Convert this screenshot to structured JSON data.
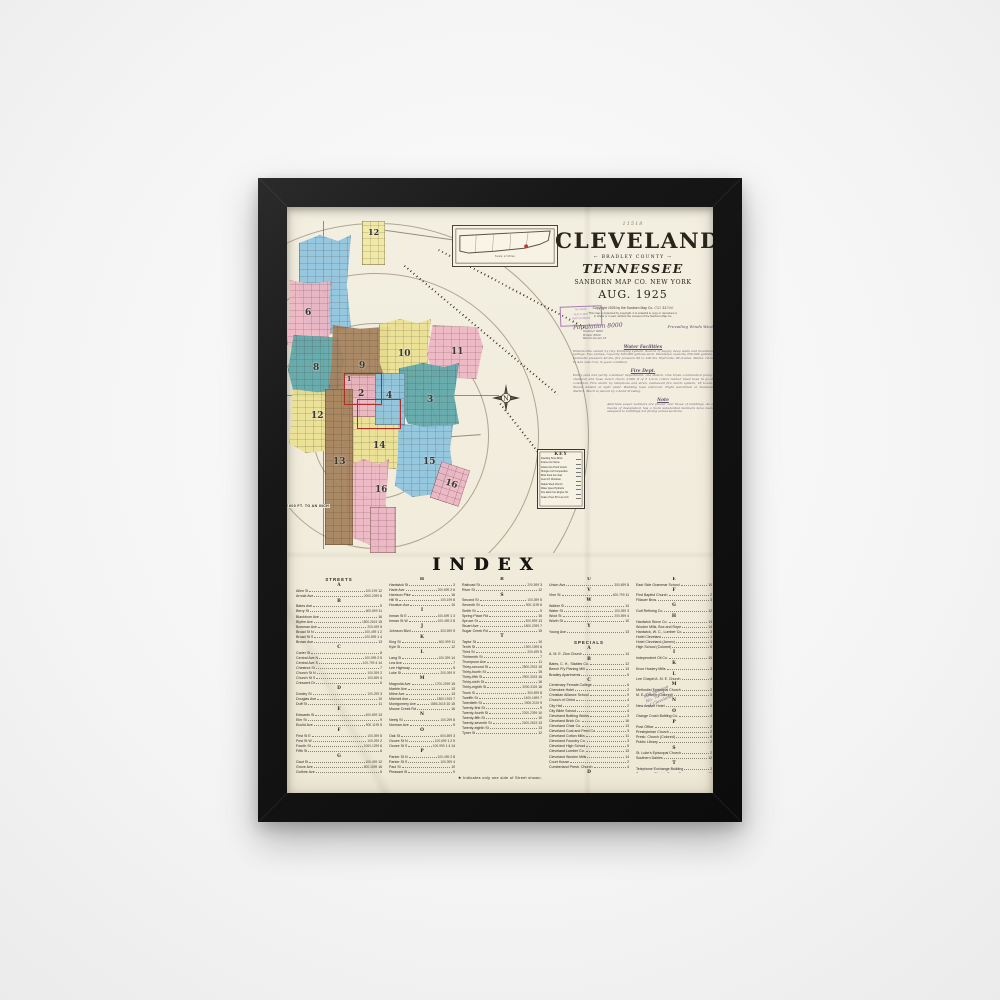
{
  "title_block": {
    "scrawl_top": "11518",
    "city": "CLEVELAND",
    "county_line": "← BRADLEY COUNTY →",
    "state": "TENNESSEE",
    "publisher": "SANBORN MAP CO. NEW YORK",
    "date": "AUG. 1925",
    "copyright": "Copyright 1925 by the Sanborn Map Co.",
    "serial": "CSI 44506",
    "legal_1": "This map is protected by copyright. It is unlawful to copy or reproduce it,",
    "legal_2": "in whole or in part, without the consent of the Sanborn Map Co."
  },
  "stamp": {
    "lines": [
      "No 11518",
      "AUG 6 1925",
      "MAP DIVISION"
    ]
  },
  "notes": {
    "population": "Population 8000",
    "winds": "Prevailing Winds West",
    "pop_sub_1": "Summer 9000",
    "pop_sub_2": "Winter 8000",
    "pop_sub_3": "Wards shown 16",
    "water_heading": "Water Facilities",
    "water_text": "Waterworks owned by city. Pumping system. Source of supply deep wells and mountain springs. Two pumps, capacity 500,000 gallons each. Standpipe capacity 250,000 gallons. Domestic pressure 40 lbs, fire pressure 60 to 100 lbs. Hydrants: 96 double. Mains: 10-in to 4-in cast iron, in good condition.",
    "fire_heading": "Fire Dept.",
    "fire_text": "Partly paid and partly volunteer department, one station. One triple combination pump, chemical and hose motor truck; 2,000 ft of 2 1/2-in cotton rubber lined hose in good condition. Fire alarm by telephone and siren. Gamewell fire alarm system, 18 boxes. Steam whistle at light plant. Building laws enforced. Night watchman at business district. Much is placed by a hand drawing.",
    "note_heading": "Note",
    "note_text": "Alternate paper numbers are placed over those of buildings. As a means of designation has a more substantial numbers have been assigned to buildings not facing actual sections."
  },
  "map": {
    "wards": [
      "12",
      "7",
      "6",
      "8",
      "9",
      "10",
      "11",
      "2",
      "4",
      "3",
      "12",
      "13",
      "14",
      "15",
      "16",
      "16",
      "1"
    ],
    "scale_label": "600 FT. TO AN INCH",
    "compass_letter": "N",
    "inset_caption": "Scale of Miles",
    "colors": {
      "pink": "#edb6c4",
      "blue": "#8ec4df",
      "teal": "#5fa7ab",
      "brown": "#a5825e",
      "yellow": "#ebe193",
      "red_outline": "#a8322a"
    }
  },
  "key": {
    "title": "KEY",
    "lines": [
      "Dwelling  Store  Brick",
      "Frame  Iron  Stone",
      "Adobe  Fire Proof Constr.",
      "Shingle roof  Composition",
      "Brick lined  Iron clad",
      "Auto  F.P.  Windows",
      "Stable  Shed  Church",
      "Water pipes  Hydrants",
      "Fire alarm box  Engine Ho.",
      "Scale of feet 50 to an inch"
    ]
  },
  "side_note": {
    "line_1": "Mill Division",
    "line_2": "No. 70-72",
    "line_3": "of Cleveland"
  },
  "index": {
    "title": "INDEX",
    "footnote": "★ Indicates only one side of Street shown.",
    "columns": [
      [
        "!STREETS",
        "#A",
        "Allen St|100-199|12",
        "Arnold Ave|2000-2099|6",
        "#B",
        "Bates Ave||9",
        "Berry St|600-899|11",
        "Blackburn Ave||16",
        "Blythe Ave|1800-2615|15",
        "Bowman Ave|200-499|5",
        "Broad St N|100-499|1 2",
        "Broad St S|100-899|1 4",
        "Brown Ave||13",
        "#C",
        "Carter St||8",
        "Central Ave N|100-599|2 5",
        "Central Ave S|100-799|4 14",
        "Chestnut St||7",
        "Church St N|100-399|2",
        "Church St S|100-599|4",
        "Crescent Dr||6",
        "#D",
        "Dooley St|100-299|3",
        "Douglas Ave||10",
        "Duff St||11",
        "#E",
        "Edwards St|400-699|13",
        "Elm St||9",
        "Euclid Ave|900-1199|5",
        "#F",
        "First St E|100-399|5",
        "First St W|100-299|2",
        "Fourth St|1000-1299|6",
        "Fifth St||6",
        "#G",
        "Gaut St|100-499|12",
        "Grove Ave|800-1099|16",
        "Guthrie Ave||5"
      ],
      [
        "#H",
        "Hardwick St||3",
        "Harle Ave|200-899|2 6",
        "Harrison Pike||16",
        "Hill St|100-199|8",
        "Houston Ave||10",
        "#I",
        "Inman St E|100-699|1 3",
        "Inman St W|100-499|2 8",
        "#J",
        "Johnson Blvd|300-599|5",
        "#K",
        "King St|600-999|11",
        "Kyle St||12",
        "#L",
        "Lang St|100-399|14",
        "Lea Ave||7",
        "Lee Highway||5",
        "Luke St|200-399|9",
        "#M",
        "Magnolia Ave|1700-2099|15",
        "Marble Ave||13",
        "Milne Ave||13",
        "Mitchell Ave|1800-1915|7",
        "Montgomery Ave|1886-2615|10 15",
        "Mouse Creek Rd||16",
        "#N",
        "Neely St|100-299|8",
        "Norman Ave||9",
        "#O",
        "Oak St|600-899|3",
        "Ocoee St N|100-699|1 2 5",
        "Ocoee St S|100-999|1 4 14",
        "#P",
        "Parker St N|100-499|2 8",
        "Parker St S|100-399|4",
        "Paul St||10",
        "Pleasant St||9"
      ],
      [
        "#R",
        "Railroad St|200-599|3",
        "River St||12",
        "#S",
        "Second St|100-399|5",
        "Seventh St|900-1199|6",
        "Smith St||9",
        "Spring Place Rd||16",
        "Spruce St|300-599|13",
        "Stuart Ave|1800-2099|7",
        "Sugar Creek Rd||15",
        "#T",
        "Taylor St||10",
        "Tenth St|1300-1599|6",
        "Third St|200-499|5",
        "Thirteenth St||7",
        "Thompson Ave||11",
        "Thirty-second St|2800-2915|15",
        "Thirty-fourth St||15",
        "Thirty-fifth St|2900-3015|16",
        "Thirty-sixth St||16",
        "Thirty-eighth St|3000-3115|16",
        "Trunk St|300-599|8",
        "Twelfth St|1400-1699|7",
        "Twentieth St|1900-2115|9",
        "Twenty-first St||9",
        "Twenty-fourth St|2200-2399|10",
        "Twenty-fifth St||10",
        "Twenty-seventh St|2400-2615|13",
        "Twenty-eighth St||13",
        "Tyner St||12"
      ],
      [
        "#U",
        "Union Ave|300-699|8",
        "#V",
        "Vine St|400-799|11",
        "#W",
        "Walker St||14",
        "Water St|100-399|3",
        "Wool St|200-599|4",
        "Worth St||10",
        "#Y",
        "Young Ave||13",
        "",
        "!SPECIALS",
        "#A",
        "A. M. E. Zion Church||14",
        "#B",
        "Bates, C. H., Stables Co.||12",
        "Beech R'y Planing Mill||13",
        "Bradley Apartments||5",
        "#C",
        "Centenary Female College||6",
        "Cherokee Hotel||2",
        "Christian Alliance School||9",
        "Church of Christ||4",
        "City Hall||2",
        "City Bible School||4",
        "Cleveland Bottling Works||3",
        "Cleveland Brick Co.||16",
        "Cleveland Chair Co.||13",
        "Cleveland Coal and Feed Co.||3",
        "Cleveland Cotton Mills||11",
        "Cleveland Foundry Co.||3",
        "Cleveland High School||5",
        "Cleveland Lumber Co.||13",
        "Cleveland Woolen Mills||14",
        "Court House||2",
        "Cumberland Presb. Church||4",
        "#D",
        "Dixie Foundry Co.||12"
      ],
      [
        "#E",
        "East Side Grammar School||10",
        "#F",
        "First Baptist Church||2",
        "Fillauer Bros.||3",
        "#G",
        "Gulf Refining Co.||12",
        "#H",
        "Hardwick Stove Co.||14",
        "Woolen Mills, Box and Rope||14",
        "Hardwick, W. C., Lumber Co.||3",
        "Hotel Cleveland||1",
        "Hotel Cleveland (Annex)||1",
        "High School (Colored)||8",
        "#I",
        "Independent Oil Co.||10",
        "#K",
        "Knox Hosiery Mills||3",
        "#L",
        "Lee Chapel A. M. E. Church||4",
        "#M",
        "Methodist Episcopal Church||2",
        "M. E. Church (Colored)||3",
        "#N",
        "New Amaze Hotel||5",
        "#O",
        "Orange Crush Bottling Co.||4",
        "#P",
        "Post Office||2",
        "Presbyterian Church||2",
        "Presb. Church (Colored)||8",
        "Public Library||2",
        "#S",
        "St. Luke's Episcopal Church||2",
        "Southern Dairies||12",
        "#T",
        "Telephone Exchange Building||2",
        "Tennessee Electric Power Co.||12",
        "#W",
        "Walker Mill||14"
      ]
    ]
  }
}
